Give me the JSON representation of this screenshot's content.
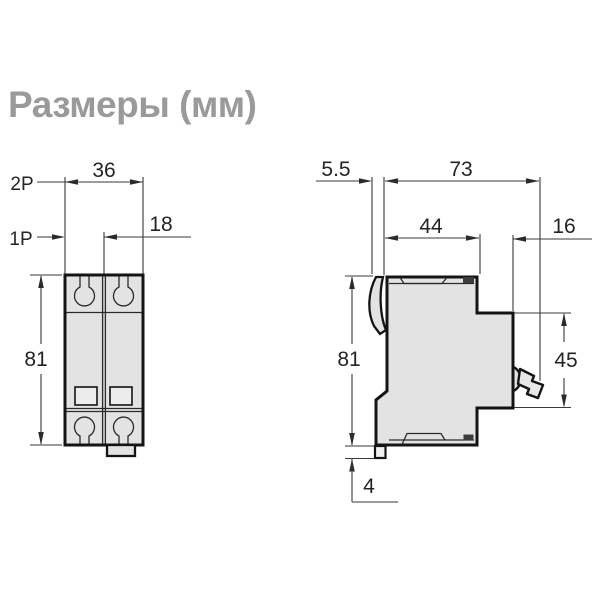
{
  "title": "Размеры (мм)",
  "colors": {
    "title_gray": "#9a9a9a",
    "body_fill": "#e3e3e3",
    "outline": "#141414",
    "dimension_line": "#3a3a3a"
  },
  "front_view": {
    "pole2_label": "2P",
    "pole1_label": "1P",
    "width_2p": "36",
    "width_1p": "18",
    "height": "81"
  },
  "side_view": {
    "clip_offset": "5.5",
    "total_depth": "73",
    "upper_depth": "44",
    "handle_depth": "16",
    "height": "81",
    "front_height": "45",
    "foot_height": "4"
  }
}
